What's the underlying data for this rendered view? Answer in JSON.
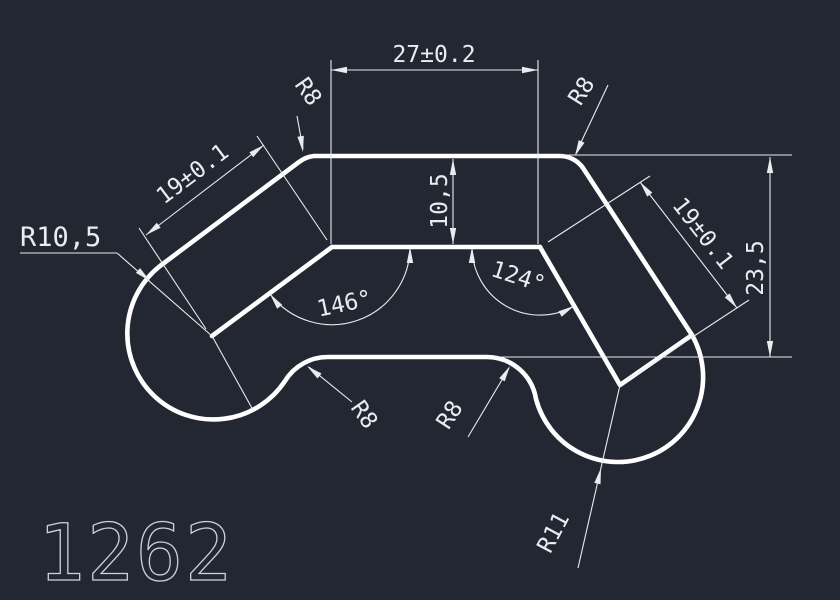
{
  "drawing": {
    "title": "1262",
    "colors": {
      "background": "#232732",
      "outline": "#ffffff",
      "dimension": "#e9ebef",
      "title_stroke": "#ccd2dc"
    },
    "labels": {
      "top_width": "27±0.2",
      "band_thickness": "10,5",
      "right_height": "23,5",
      "left_leg_length": "19±0.1",
      "right_leg_length": "19±0.1",
      "left_angle": "146°",
      "right_angle": "124°",
      "fillet_top_left": "R8",
      "fillet_top_right": "R8",
      "fillet_bottom_left": "R8",
      "fillet_bottom_right": "R8",
      "left_cap_radius": "R10,5",
      "right_cap_radius": "R11"
    }
  }
}
